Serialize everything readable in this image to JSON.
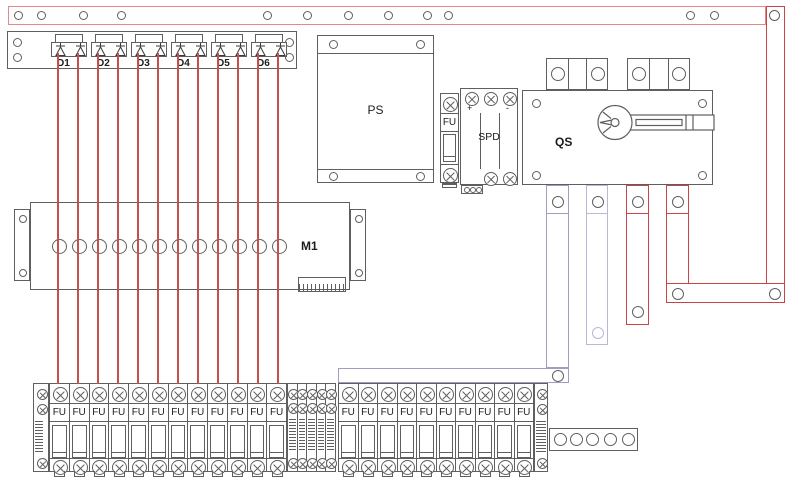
{
  "title": "PV combiner cabinet layout drawing",
  "colors": {
    "outline": "#5f5f5f",
    "wire_red": "#c65050",
    "rail_red": "#e2898b",
    "busbar_red": "#c64646",
    "busbar_purple": "#9e9ec4",
    "busbar_purple_light": "#b8b8d8",
    "text": "#1c1c1c"
  },
  "top_rail": {
    "hole_count": 12
  },
  "right_busbar": {
    "hole_count": 1
  },
  "diode_panel": {
    "modules": [
      {
        "label": "D1"
      },
      {
        "label": "D2"
      },
      {
        "label": "D3"
      },
      {
        "label": "D4"
      },
      {
        "label": "D5"
      },
      {
        "label": "D6"
      }
    ]
  },
  "power_supply": {
    "label": "PS"
  },
  "fuse_module": {
    "label": "FU"
  },
  "spd_module": {
    "label": "SPD",
    "terminal_plus": "+",
    "terminal_minus": "-"
  },
  "disconnect_switch": {
    "label": "QS"
  },
  "monitor_module": {
    "label": "M1",
    "hole_count": 12
  },
  "fuse_terminals": {
    "group1": {
      "count": 12,
      "label": "FU"
    },
    "narrow_group": {
      "count": 5
    },
    "group2": {
      "count": 10,
      "label": "FU"
    }
  },
  "aux_block": {
    "hole_count": 5
  }
}
